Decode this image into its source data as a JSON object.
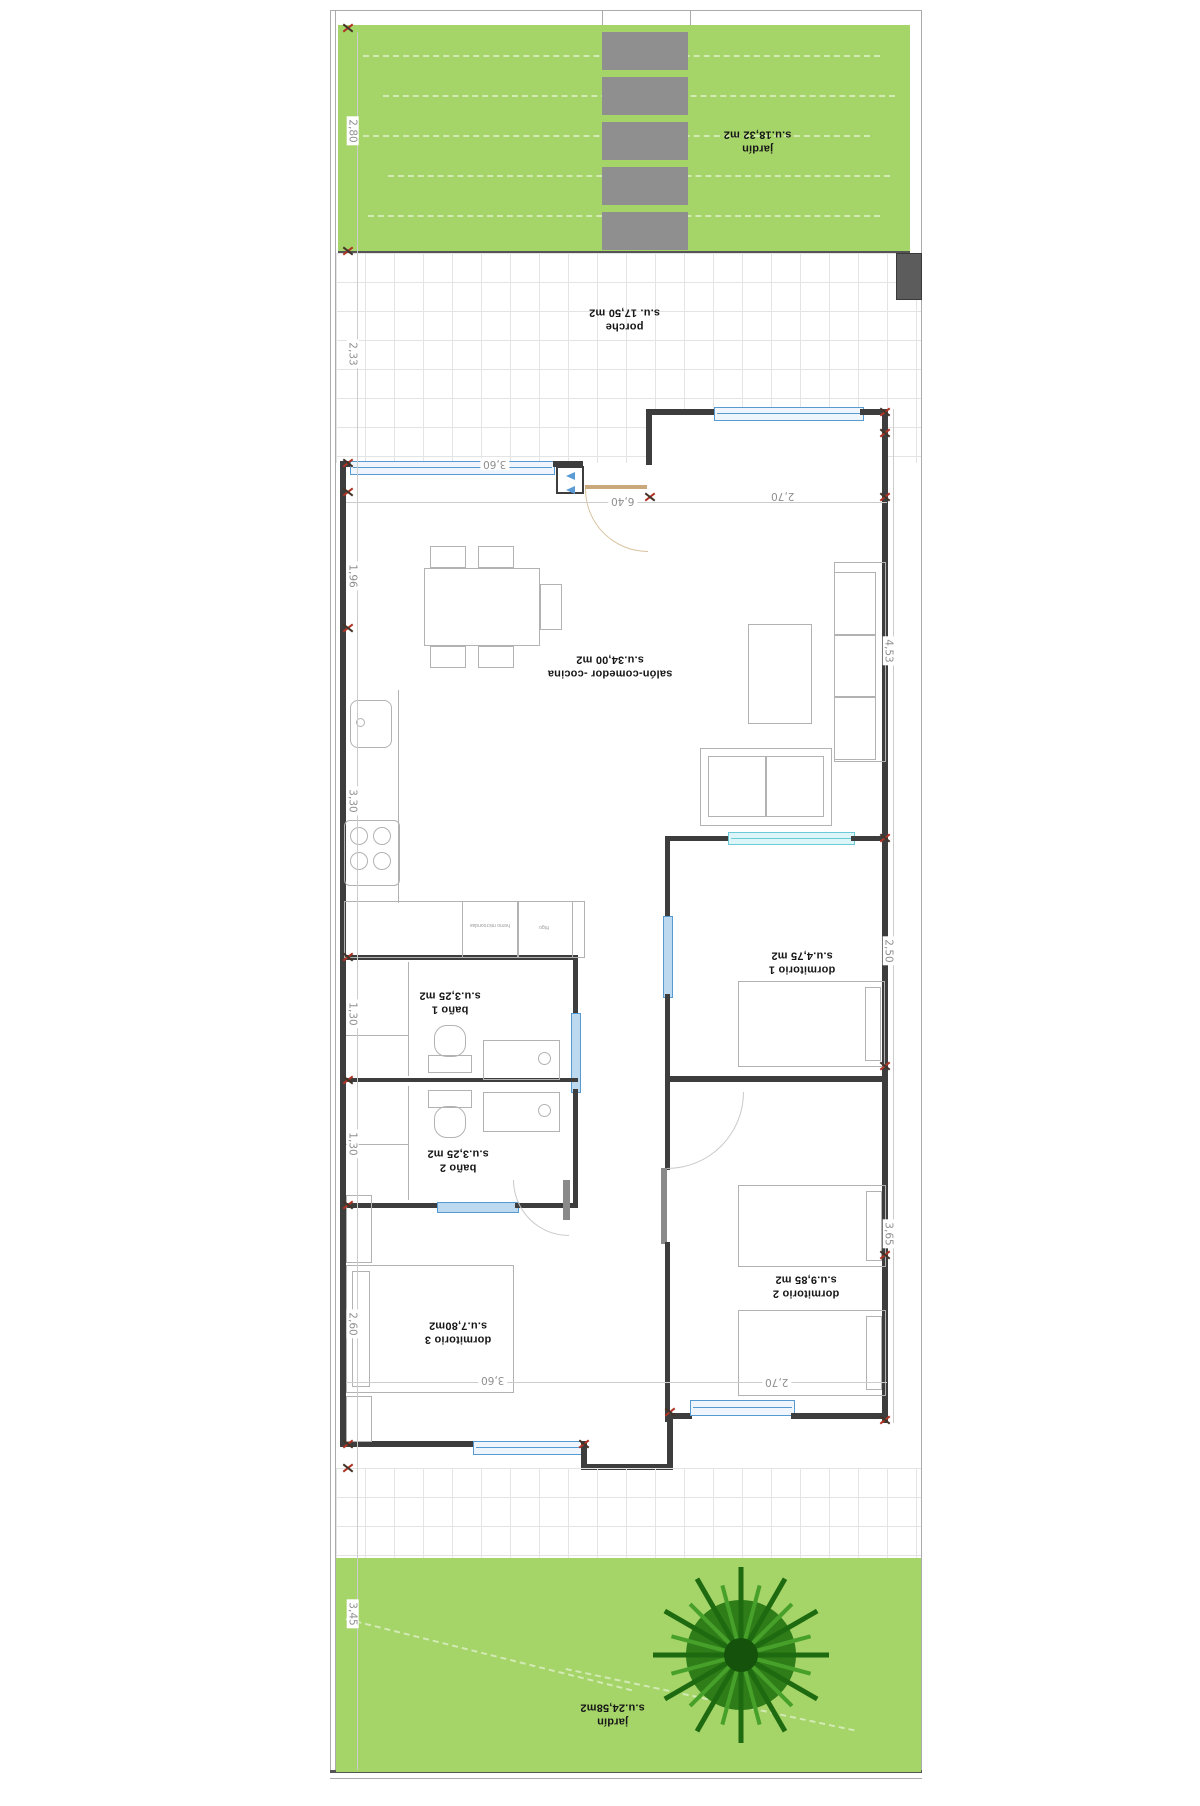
{
  "plan_title": "floor plan (rotated 180°)",
  "colors": {
    "garden_green": "#a5d468",
    "grass_streak": "rgba(255,255,255,0.5)",
    "slat_gray": "#8f8f8f",
    "pillar_gray": "#5c5c5c",
    "wall_dark": "#3d3d3d",
    "window_blue": "#569ad2",
    "slider_cyan": "#6cc9d6",
    "door_tan": "#c9a87c",
    "furniture_line": "#b2b2b2",
    "dim_gray": "#8f8f8f",
    "marker_red": "#b03324",
    "tile_line": "#e4e4e4",
    "tree_green": "#2e7d18"
  },
  "rooms": {
    "jardin_top": {
      "name": "jardín",
      "area": "s.u.18,32 m2"
    },
    "porche": {
      "name": "porche",
      "area": "s.u. 17,50 m2"
    },
    "salon": {
      "name": "salón-comedor -cocina",
      "area": "s.u.34,00 m2"
    },
    "dormitorio1": {
      "name": "dormitorio 1",
      "area": "s.u.4,75 m2"
    },
    "bano1": {
      "name": "baño 1",
      "area": "s.u.3,25 m2"
    },
    "bano2": {
      "name": "baño 2",
      "area": "s.u.3,25 m2"
    },
    "dormitorio3": {
      "name": "dormitorio 3",
      "area": "s.u.7,80m2"
    },
    "dormitorio2": {
      "name": "dormitorio 2",
      "area": "s.u.9,85 m2"
    },
    "jardin_bottom": {
      "name": "jardín",
      "area": "s.u.24,58m2"
    }
  },
  "appliances": {
    "oven": "horno microondas",
    "fridge": "frigo"
  },
  "dimensions": {
    "garden_top_h": "2,80",
    "porch_h": "2,33",
    "living_left_h": "1,96",
    "kitchen_h": "3,30",
    "bath1_h": "1,30",
    "bath2_h": "1,30",
    "dorm3_h": "2,60",
    "garden_bottom_h": "3,45",
    "living_window_w": "3,60",
    "total_w": "6,40",
    "entry_w": "2,70",
    "living_right_h": "4,53",
    "dorm1_h": "2,50",
    "dorm2_h": "3,65",
    "dorm2_w": "2,70",
    "dorm3_w": "3,60"
  }
}
